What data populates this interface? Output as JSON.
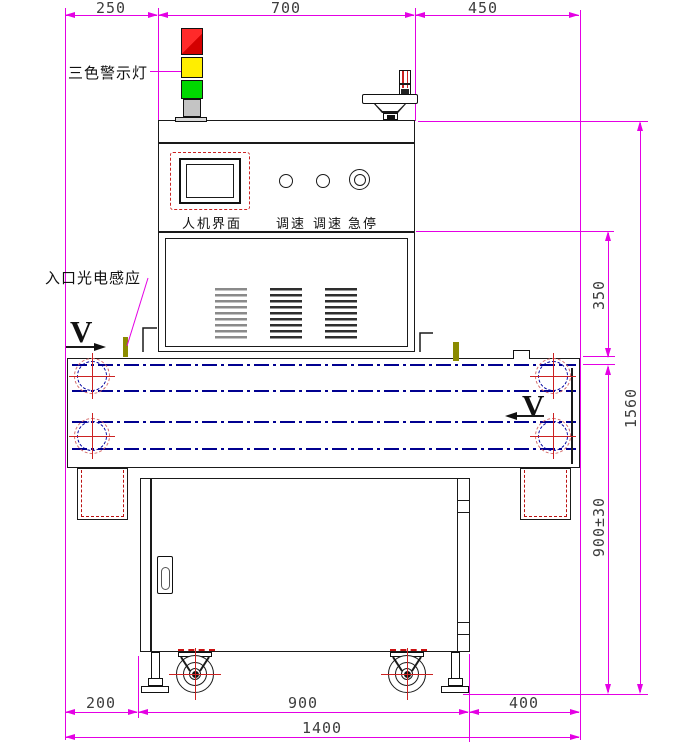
{
  "labels": {
    "tower_light": "三色警示灯",
    "entry_sensor": "入口光电感应",
    "hmi": "人机界面",
    "speed_left": "调速",
    "speed_right": "调速",
    "estop": "急停",
    "direction_left": "V",
    "direction_right": "V"
  },
  "dimensions": {
    "top_left": "250",
    "top_center": "700",
    "top_right": "450",
    "right_upper": "350",
    "right_lower": "900±30",
    "right_overall": "1560",
    "bottom_left": "200",
    "bottom_center": "900",
    "bottom_right": "400",
    "bottom_overall": "1400"
  },
  "colors": {
    "dimension_line": "#e400e4",
    "outline": "#1a1a1a",
    "belt_centerline": "#000090",
    "hidden_red": "#cc1111",
    "tower_red": "#f01010",
    "tower_yellow": "#ffee00",
    "tower_green": "#00d800",
    "sensor_olive": "#8b8b00"
  }
}
